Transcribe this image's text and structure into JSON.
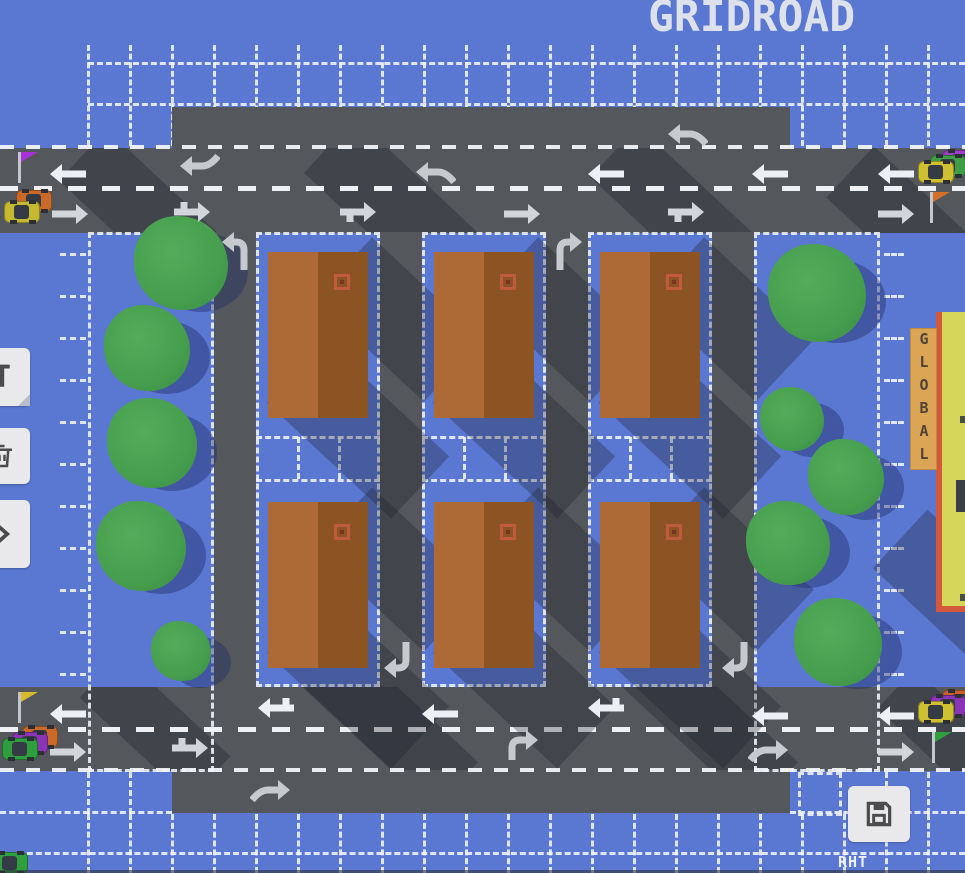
{
  "title": "GRIDROAD",
  "mode_label": "RHT",
  "sign_text": "GLOBAL",
  "toolbar": {
    "left_buttons": [
      {
        "name": "text-tool-button",
        "icon": "text-cursor-icon"
      },
      {
        "name": "delete-button",
        "icon": "trash-icon"
      },
      {
        "name": "expand-button",
        "icon": "chevron-right-icon"
      }
    ],
    "save_button": {
      "name": "save-button",
      "icon": "floppy-disk-icon"
    }
  },
  "colors": {
    "background": "#5a78d2",
    "road": "#54585c",
    "grid_line": "#eef1f8",
    "lane_dash": "#eef0f4",
    "arrow_bright": "#eceff3",
    "arrow_dim": "#d2d5da",
    "arrow_muted": "#c6cacf",
    "building_left": "#ad6a36",
    "building_right": "#8c5423",
    "building_vent": "#bf5a3c",
    "tree": "#47a04f",
    "sign_bg": "#dca455",
    "global_building": "#d6d75a",
    "global_trim": "#d4593c",
    "flag_purple": "#a832d8",
    "flag_orange": "#d2702a",
    "flag_yellow": "#d7b92f",
    "flag_green": "#2f9e3f",
    "button_bg": "#e9e9eb",
    "icon": "#4b4b4d"
  },
  "map": {
    "roads": {
      "top_extension": {
        "x": 172,
        "y": 107,
        "w": 618,
        "h": 42
      },
      "top_road": {
        "x": 0,
        "y": 148,
        "w": 965,
        "h": 85
      },
      "bottom_road": {
        "x": 0,
        "y": 687,
        "w": 965,
        "h": 84
      },
      "bottom_extension": {
        "x": 172,
        "y": 770,
        "w": 618,
        "h": 43
      },
      "vertical_roads": [
        {
          "x": 214,
          "y": 232,
          "w": 42,
          "h": 455
        },
        {
          "x": 380,
          "y": 232,
          "w": 42,
          "h": 455
        },
        {
          "x": 546,
          "y": 232,
          "w": 42,
          "h": 455
        },
        {
          "x": 712,
          "y": 232,
          "w": 42,
          "h": 455
        }
      ]
    },
    "park_cells": [
      {
        "x": 88,
        "y": 232,
        "w": 126,
        "h": 540
      },
      {
        "x": 754,
        "y": 232,
        "w": 126,
        "h": 540
      }
    ],
    "block_cells": [
      {
        "x": 256,
        "y": 232,
        "w": 124,
        "h": 455
      },
      {
        "x": 422,
        "y": 232,
        "w": 124,
        "h": 455
      },
      {
        "x": 588,
        "y": 232,
        "w": 124,
        "h": 455
      }
    ],
    "save_cell": {
      "x": 798,
      "y": 772,
      "w": 44,
      "h": 44
    },
    "buildings": [
      {
        "x": 268,
        "y": 252
      },
      {
        "x": 434,
        "y": 252
      },
      {
        "x": 600,
        "y": 252
      },
      {
        "x": 268,
        "y": 502
      },
      {
        "x": 434,
        "y": 502
      },
      {
        "x": 600,
        "y": 502
      }
    ],
    "trees": [
      {
        "x": 181,
        "y": 263,
        "r": 47
      },
      {
        "x": 147,
        "y": 348,
        "r": 43
      },
      {
        "x": 152,
        "y": 443,
        "r": 45
      },
      {
        "x": 141,
        "y": 546,
        "r": 45
      },
      {
        "x": 181,
        "y": 651,
        "r": 30
      },
      {
        "x": 817,
        "y": 293,
        "r": 49
      },
      {
        "x": 792,
        "y": 419,
        "r": 32
      },
      {
        "x": 846,
        "y": 477,
        "r": 38
      },
      {
        "x": 788,
        "y": 543,
        "r": 42
      },
      {
        "x": 838,
        "y": 642,
        "r": 44
      }
    ],
    "arrows": [
      {
        "x": 664,
        "y": 112,
        "t": "merge-w"
      },
      {
        "x": 46,
        "y": 152,
        "t": "w"
      },
      {
        "x": 176,
        "y": 144,
        "t": "hook-w-up"
      },
      {
        "x": 412,
        "y": 150,
        "t": "merge-w"
      },
      {
        "x": 584,
        "y": 152,
        "t": "w"
      },
      {
        "x": 748,
        "y": 152,
        "t": "w"
      },
      {
        "x": 874,
        "y": 152,
        "t": "w"
      },
      {
        "x": 48,
        "y": 192,
        "t": "e"
      },
      {
        "x": 170,
        "y": 190,
        "t": "e-tick-up"
      },
      {
        "x": 336,
        "y": 190,
        "t": "e-tick-down"
      },
      {
        "x": 500,
        "y": 192,
        "t": "e"
      },
      {
        "x": 664,
        "y": 190,
        "t": "e-tick-down"
      },
      {
        "x": 874,
        "y": 192,
        "t": "e"
      },
      {
        "x": 212,
        "y": 228,
        "t": "turn-nw"
      },
      {
        "x": 548,
        "y": 228,
        "t": "turn-ne"
      },
      {
        "x": 378,
        "y": 640,
        "t": "turn-sw"
      },
      {
        "x": 716,
        "y": 640,
        "t": "turn-sw"
      },
      {
        "x": 46,
        "y": 692,
        "t": "w"
      },
      {
        "x": 254,
        "y": 686,
        "t": "w-tick-up"
      },
      {
        "x": 418,
        "y": 692,
        "t": "w"
      },
      {
        "x": 584,
        "y": 686,
        "t": "w-tick-up"
      },
      {
        "x": 748,
        "y": 694,
        "t": "w"
      },
      {
        "x": 874,
        "y": 694,
        "t": "w"
      },
      {
        "x": 46,
        "y": 730,
        "t": "e"
      },
      {
        "x": 168,
        "y": 726,
        "t": "e-tick-up"
      },
      {
        "x": 500,
        "y": 722,
        "t": "turn-en"
      },
      {
        "x": 748,
        "y": 728,
        "t": "merge-e"
      },
      {
        "x": 874,
        "y": 730,
        "t": "e"
      },
      {
        "x": 250,
        "y": 768,
        "t": "merge-e"
      }
    ],
    "cars": [
      {
        "x": 4,
        "y": 190,
        "fleet": [
          {
            "c": "#c9692a",
            "dx": 12,
            "dy": 0
          },
          {
            "c": "#c4b930",
            "dx": 0,
            "dy": 11
          }
        ]
      },
      {
        "x": 918,
        "y": 150,
        "fleet": [
          {
            "c": "#9b3fc4",
            "dx": 24,
            "dy": 0
          },
          {
            "c": "#3f9e45",
            "dx": 12,
            "dy": 5
          },
          {
            "c": "#cfc032",
            "dx": 0,
            "dy": 11
          }
        ]
      },
      {
        "x": 2,
        "y": 726,
        "fleet": [
          {
            "c": "#c9692a",
            "dx": 20,
            "dy": 0
          },
          {
            "c": "#8a35b5",
            "dx": 10,
            "dy": 6
          },
          {
            "c": "#2f9e3f",
            "dx": 0,
            "dy": 12
          }
        ]
      },
      {
        "x": 918,
        "y": 690,
        "fleet": [
          {
            "c": "#c9622a",
            "dx": 24,
            "dy": 0
          },
          {
            "c": "#8a35b5",
            "dx": 12,
            "dy": 5
          },
          {
            "c": "#cfc032",
            "dx": 0,
            "dy": 11
          }
        ]
      },
      {
        "x": -8,
        "y": 852,
        "fleet": [
          {
            "c": "#2f9e3f",
            "dx": 0,
            "dy": 0
          }
        ]
      }
    ],
    "flags": [
      {
        "x": 16,
        "y": 152,
        "c": "#a832d8",
        "name": "flag-purple"
      },
      {
        "x": 928,
        "y": 192,
        "c": "#d2702a",
        "name": "flag-orange"
      },
      {
        "x": 16,
        "y": 692,
        "c": "#d7b92f",
        "name": "flag-yellow"
      },
      {
        "x": 930,
        "y": 732,
        "c": "#2f9e3f",
        "name": "flag-green"
      }
    ],
    "building_shadows": [
      {
        "x": 323,
        "y": 277,
        "w": 150,
        "h": 85,
        "rot": 43
      },
      {
        "x": 273,
        "y": 387,
        "w": 170,
        "h": 85,
        "rot": 43
      },
      {
        "x": 489,
        "y": 277,
        "w": 150,
        "h": 85,
        "rot": 43
      },
      {
        "x": 439,
        "y": 387,
        "w": 170,
        "h": 85,
        "rot": 43
      },
      {
        "x": 655,
        "y": 277,
        "w": 150,
        "h": 85,
        "rot": 43
      },
      {
        "x": 605,
        "y": 387,
        "w": 170,
        "h": 85,
        "rot": 43
      },
      {
        "x": 323,
        "y": 527,
        "w": 150,
        "h": 85,
        "rot": 43
      },
      {
        "x": 273,
        "y": 637,
        "w": 170,
        "h": 85,
        "rot": 43
      },
      {
        "x": 489,
        "y": 527,
        "w": 150,
        "h": 85,
        "rot": 43
      },
      {
        "x": 439,
        "y": 637,
        "w": 170,
        "h": 85,
        "rot": 43
      },
      {
        "x": 655,
        "y": 527,
        "w": 150,
        "h": 85,
        "rot": 43
      },
      {
        "x": 605,
        "y": 637,
        "w": 170,
        "h": 85,
        "rot": 43
      },
      {
        "x": 880,
        "y": 550,
        "w": 150,
        "h": 80,
        "rot": 43
      }
    ],
    "top_road_shadows": [
      {
        "x": 60,
        "y": 30,
        "w": 170,
        "h": 70
      },
      {
        "x": 300,
        "y": 35,
        "w": 220,
        "h": 75
      },
      {
        "x": 590,
        "y": 30,
        "w": 180,
        "h": 70
      },
      {
        "x": 830,
        "y": 40,
        "w": 150,
        "h": 70
      }
    ],
    "bottom_road_shadows": [
      {
        "x": 80,
        "y": 10,
        "w": 150,
        "h": 60
      },
      {
        "x": 300,
        "y": 5,
        "w": 180,
        "h": 65
      },
      {
        "x": 620,
        "y": 5,
        "w": 180,
        "h": 65
      },
      {
        "x": 880,
        "y": 15,
        "w": 120,
        "h": 55
      }
    ]
  }
}
